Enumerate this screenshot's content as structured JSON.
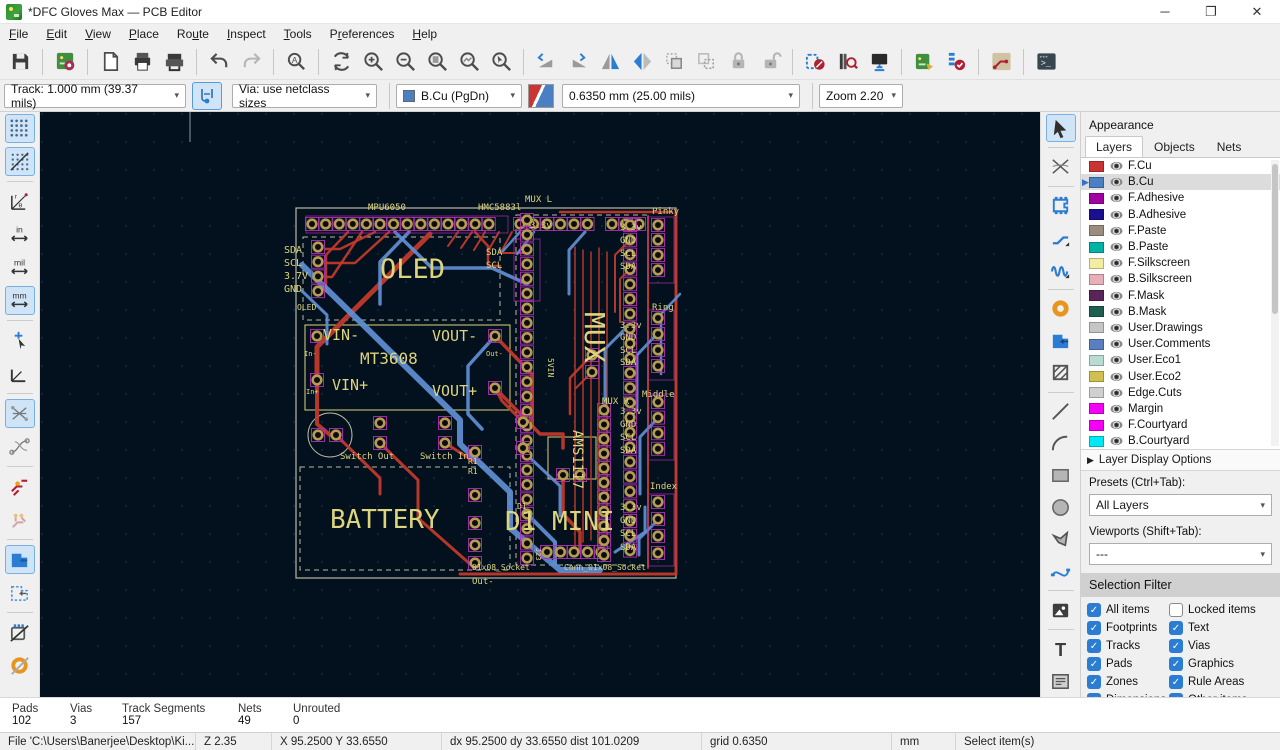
{
  "window": {
    "title": "*DFC Gloves Max — PCB Editor"
  },
  "menu": {
    "items": [
      "&File",
      "&Edit",
      "&View",
      "&Place",
      "Ro&ute",
      "&Inspect",
      "&Tools",
      "P&references",
      "&Help"
    ]
  },
  "toolbar_main": [
    "save",
    "|",
    "board-setup",
    "|",
    "page-settings",
    "print",
    "plot",
    "|",
    "undo",
    "redo:disabled",
    "|",
    "find",
    "|",
    "refresh",
    "zoom-in",
    "zoom-out",
    "zoom-fit",
    "zoom-objects",
    "zoom-selection",
    "|",
    "rotate-ccw",
    "rotate-cw",
    "flip-horizontal",
    "mirror",
    "group",
    "ungroup",
    "lock",
    "unlock",
    "|",
    "footprint-editor",
    "footprint-browser",
    "3d-viewer",
    "|",
    "update-pcb",
    "drc",
    "|",
    "route-style",
    "|",
    "scripting-console"
  ],
  "toolbar2": {
    "track": "Track: 1.000 mm (39.37 mils)",
    "via": "Via: use netclass sizes",
    "layer": "B.Cu (PgDn)",
    "layer_color": "#4a7fc1",
    "grid": "0.6350 mm (25.00 mils)",
    "zoom": "Zoom 2.20"
  },
  "left_toolbar": [
    "grid:active",
    "grid-overrides:active",
    "polar-coords",
    "units-inches",
    "units-mils",
    "units-mm:active",
    "cursor-shape",
    "free-angle",
    "ratsnest:active",
    "curved-ratsnest",
    "net-highlight",
    "track-display",
    "zone-fill:active",
    "zone-outline",
    "footprint-hide",
    "pad-hide"
  ],
  "right_toolbar": [
    "select:active",
    "local-ratsnest",
    "place-footprint",
    "route-tracks",
    "tune-length",
    "place-via",
    "draw-zone",
    "rule-area",
    "draw-line",
    "draw-arc",
    "draw-rect",
    "draw-circle",
    "draw-polygon",
    "draw-bezier",
    "place-image",
    "place-text",
    "place-textbox"
  ],
  "appearance": {
    "title": "Appearance",
    "tabs": [
      "Layers",
      "Objects",
      "Nets"
    ],
    "active_tab": "Layers",
    "layers": [
      {
        "name": "F.Cu",
        "color": "#c83434",
        "selected": false
      },
      {
        "name": "B.Cu",
        "color": "#4a7fc1",
        "selected": true
      },
      {
        "name": "F.Adhesive",
        "color": "#a000a0",
        "selected": false
      },
      {
        "name": "B.Adhesive",
        "color": "#1a0f8f",
        "selected": false
      },
      {
        "name": "F.Paste",
        "color": "#9a8d80",
        "selected": false
      },
      {
        "name": "B.Paste",
        "color": "#00b1a5",
        "selected": false
      },
      {
        "name": "F.Silkscreen",
        "color": "#f2eda0",
        "selected": false
      },
      {
        "name": "B.Silkscreen",
        "color": "#e8aeba",
        "selected": false
      },
      {
        "name": "F.Mask",
        "color": "#592458",
        "selected": false
      },
      {
        "name": "B.Mask",
        "color": "#1e5f52",
        "selected": false
      },
      {
        "name": "User.Drawings",
        "color": "#c5c5c5",
        "selected": false
      },
      {
        "name": "User.Comments",
        "color": "#5a7fc0",
        "selected": false
      },
      {
        "name": "User.Eco1",
        "color": "#b8dcd2",
        "selected": false
      },
      {
        "name": "User.Eco2",
        "color": "#cfc04f",
        "selected": false
      },
      {
        "name": "Edge.Cuts",
        "color": "#d0d0d0",
        "selected": false
      },
      {
        "name": "Margin",
        "color": "#f400f4",
        "selected": false
      },
      {
        "name": "F.Courtyard",
        "color": "#f400f4",
        "selected": false
      },
      {
        "name": "B.Courtyard",
        "color": "#00e8f4",
        "selected": false
      }
    ],
    "layer_display_options": "Layer Display Options",
    "presets_label": "Presets (Ctrl+Tab):",
    "presets_value": "All Layers",
    "viewports_label": "Viewports (Shift+Tab):",
    "viewports_value": "---",
    "selection_filter": {
      "title": "Selection Filter",
      "items": [
        {
          "label": "All items",
          "checked": true
        },
        {
          "label": "Locked items",
          "checked": false
        },
        {
          "label": "Footprints",
          "checked": true
        },
        {
          "label": "Text",
          "checked": true
        },
        {
          "label": "Tracks",
          "checked": true
        },
        {
          "label": "Vias",
          "checked": true
        },
        {
          "label": "Pads",
          "checked": true
        },
        {
          "label": "Graphics",
          "checked": true
        },
        {
          "label": "Zones",
          "checked": true
        },
        {
          "label": "Rule Areas",
          "checked": true
        },
        {
          "label": "Dimensions",
          "checked": true
        },
        {
          "label": "Other items",
          "checked": true
        }
      ]
    }
  },
  "status": {
    "cols": [
      {
        "label": "Pads",
        "value": "102",
        "w": 58
      },
      {
        "label": "Vias",
        "value": "3",
        "w": 52
      },
      {
        "label": "Track Segments",
        "value": "157",
        "w": 116
      },
      {
        "label": "Nets",
        "value": "49",
        "w": 55
      },
      {
        "label": "Unrouted",
        "value": "0",
        "w": 120
      }
    ]
  },
  "statusbar": {
    "file": "File 'C:\\Users\\Banerjee\\Desktop\\Ki...",
    "z": "Z 2.35",
    "xy": "X 95.2500  Y 33.6550",
    "dxdy": "dx 95.2500  dy 33.6550  dist 101.0209",
    "grid": "grid 0.6350",
    "units": "mm",
    "action": "Select item(s)"
  },
  "canvas": {
    "bg": "#03101d",
    "grid_dot": "#16324a",
    "silk": "#ddd57e",
    "fcu": "#c0392b",
    "bcu": "#5f8fd4",
    "pad_ring": "#b59b54",
    "pad_outline": "#b030b0",
    "board": {
      "x": 256,
      "y": 96,
      "w": 380,
      "h": 370
    },
    "labels": [
      {
        "t": "MPU6050",
        "x": 328,
        "y": 98,
        "s": 9
      },
      {
        "t": "HMC5883l",
        "x": 438,
        "y": 98,
        "s": 9
      },
      {
        "t": "MUX L",
        "x": 485,
        "y": 90,
        "s": 9
      },
      {
        "t": "Pinky",
        "x": 612,
        "y": 102,
        "s": 9
      },
      {
        "t": "OLED",
        "x": 340,
        "y": 166,
        "s": 27
      },
      {
        "t": "SDA",
        "x": 244,
        "y": 141,
        "s": 10
      },
      {
        "t": "SCL",
        "x": 244,
        "y": 154,
        "s": 10
      },
      {
        "t": "3.7V",
        "x": 244,
        "y": 167,
        "s": 10
      },
      {
        "t": "GND",
        "x": 244,
        "y": 180,
        "s": 10
      },
      {
        "t": "OLED",
        "x": 257,
        "y": 198,
        "s": 8
      },
      {
        "t": "VIN-",
        "x": 283,
        "y": 228,
        "s": 15
      },
      {
        "t": "VOUT-",
        "x": 392,
        "y": 229,
        "s": 15
      },
      {
        "t": "MT3608",
        "x": 320,
        "y": 252,
        "s": 16
      },
      {
        "t": "VIN+",
        "x": 292,
        "y": 278,
        "s": 15
      },
      {
        "t": "VOUT+",
        "x": 392,
        "y": 284,
        "s": 15
      },
      {
        "t": "In-",
        "x": 264,
        "y": 244,
        "s": 7
      },
      {
        "t": "In+",
        "x": 266,
        "y": 282,
        "s": 7
      },
      {
        "t": "Out-",
        "x": 446,
        "y": 244,
        "s": 7
      },
      {
        "t": "MUX",
        "x": 545,
        "y": 200,
        "s": 28,
        "r": 90
      },
      {
        "t": "5VIN",
        "x": 508,
        "y": 246,
        "s": 8,
        "r": 90
      },
      {
        "t": "AMS1117",
        "x": 533,
        "y": 318,
        "s": 14,
        "r": 90
      },
      {
        "t": "BATTERY",
        "x": 290,
        "y": 416,
        "s": 26
      },
      {
        "t": "D1 MINI",
        "x": 465,
        "y": 418,
        "s": 26
      },
      {
        "t": "Switch Out",
        "x": 300,
        "y": 347,
        "s": 9
      },
      {
        "t": "Switch In",
        "x": 380,
        "y": 347,
        "s": 9
      },
      {
        "t": "R1",
        "x": 428,
        "y": 352,
        "s": 8
      },
      {
        "t": "R1",
        "x": 428,
        "y": 362,
        "s": 8
      },
      {
        "t": "D1",
        "x": 477,
        "y": 397,
        "s": 8
      },
      {
        "t": "MUX R",
        "x": 562,
        "y": 292,
        "s": 9
      },
      {
        "t": "Ring",
        "x": 612,
        "y": 198,
        "s": 9
      },
      {
        "t": "Middle",
        "x": 602,
        "y": 285,
        "s": 9
      },
      {
        "t": "Index",
        "x": 610,
        "y": 377,
        "s": 9
      },
      {
        "t": "3.3v",
        "x": 490,
        "y": 116,
        "s": 9
      },
      {
        "t": "SDA",
        "x": 446,
        "y": 143,
        "s": 9
      },
      {
        "t": "SCL",
        "x": 446,
        "y": 156,
        "s": 9
      },
      {
        "t": "3.3v",
        "x": 580,
        "y": 118,
        "s": 9
      },
      {
        "t": "GND",
        "x": 580,
        "y": 131,
        "s": 9
      },
      {
        "t": "SCL",
        "x": 580,
        "y": 144,
        "s": 9
      },
      {
        "t": "SDA",
        "x": 580,
        "y": 157,
        "s": 9
      },
      {
        "t": "3.3v",
        "x": 580,
        "y": 216,
        "s": 9
      },
      {
        "t": "GND",
        "x": 580,
        "y": 228,
        "s": 9
      },
      {
        "t": "SCL",
        "x": 580,
        "y": 241,
        "s": 9
      },
      {
        "t": "SDA",
        "x": 580,
        "y": 253,
        "s": 9
      },
      {
        "t": "3.3v",
        "x": 580,
        "y": 302,
        "s": 9
      },
      {
        "t": "GND",
        "x": 580,
        "y": 315,
        "s": 9
      },
      {
        "t": "SCL",
        "x": 580,
        "y": 328,
        "s": 9
      },
      {
        "t": "SDA",
        "x": 580,
        "y": 341,
        "s": 9
      },
      {
        "t": "3.3v",
        "x": 580,
        "y": 398,
        "s": 9
      },
      {
        "t": "GND",
        "x": 580,
        "y": 411,
        "s": 9
      },
      {
        "t": "SCL",
        "x": 580,
        "y": 424,
        "s": 9
      },
      {
        "t": "SDA",
        "x": 580,
        "y": 438,
        "s": 9
      },
      {
        "t": "01x08_Socket",
        "x": 432,
        "y": 458,
        "s": 8
      },
      {
        "t": "Conn_01x08_Socket",
        "x": 524,
        "y": 458,
        "s": 8
      },
      {
        "t": "Out-",
        "x": 432,
        "y": 472,
        "s": 9
      },
      {
        "t": "J23",
        "x": 496,
        "y": 436,
        "s": 7,
        "r": 90
      }
    ],
    "headers": [
      {
        "x": 272,
        "y": 112,
        "n": 14,
        "dx": 13.6,
        "dy": 0
      },
      {
        "x": 480,
        "y": 112,
        "n": 6,
        "dx": 13.5,
        "dy": 0
      },
      {
        "x": 572,
        "y": 112,
        "n": 3,
        "dx": 13.5,
        "dy": 0
      },
      {
        "x": 278,
        "y": 135,
        "n": 4,
        "dx": 0,
        "dy": 14.7
      },
      {
        "x": 487,
        "y": 108,
        "n": 24,
        "dx": 0,
        "dy": 14.7
      },
      {
        "x": 590,
        "y": 113,
        "n": 23,
        "dx": 0,
        "dy": 14.8
      },
      {
        "x": 618,
        "y": 113,
        "n": 4,
        "dx": 0,
        "dy": 15
      },
      {
        "x": 618,
        "y": 206,
        "n": 4,
        "dx": 0,
        "dy": 16
      },
      {
        "x": 618,
        "y": 290,
        "n": 4,
        "dx": 0,
        "dy": 15.6
      },
      {
        "x": 618,
        "y": 390,
        "n": 4,
        "dx": 0,
        "dy": 17
      },
      {
        "x": 507,
        "y": 440,
        "n": 5,
        "dx": 13.5,
        "dy": 0
      },
      {
        "x": 564,
        "y": 298,
        "n": 11,
        "dx": 0,
        "dy": 14.5
      }
    ],
    "pads": [
      [
        277,
        224
      ],
      [
        277,
        268
      ],
      [
        455,
        224
      ],
      [
        455,
        276
      ],
      [
        340,
        311
      ],
      [
        340,
        331
      ],
      [
        405,
        311
      ],
      [
        405,
        331
      ],
      [
        278,
        323
      ],
      [
        296,
        323
      ],
      [
        435,
        340
      ],
      [
        435,
        383
      ],
      [
        435,
        411
      ],
      [
        435,
        433
      ],
      [
        435,
        451
      ],
      [
        483,
        310
      ],
      [
        483,
        336
      ],
      [
        523,
        363
      ],
      [
        540,
        363
      ],
      [
        552,
        243
      ],
      [
        552,
        260
      ]
    ],
    "dashed_rects": [
      {
        "x": 263,
        "y": 125,
        "w": 197,
        "h": 83
      },
      {
        "x": 260,
        "y": 355,
        "w": 210,
        "h": 103
      },
      {
        "x": 476,
        "y": 103,
        "w": 132,
        "h": 350
      }
    ],
    "solid_rects": [
      {
        "x": 265,
        "y": 213,
        "w": 205,
        "h": 85
      },
      {
        "x": 508,
        "y": 325,
        "w": 48,
        "h": 42
      }
    ],
    "group_rects": [
      {
        "x": 608,
        "y": 105,
        "w": 26,
        "h": 66
      },
      {
        "x": 608,
        "y": 198,
        "w": 26,
        "h": 70
      },
      {
        "x": 608,
        "y": 282,
        "w": 26,
        "h": 66
      },
      {
        "x": 608,
        "y": 382,
        "w": 26,
        "h": 72
      },
      {
        "x": 266,
        "y": 104,
        "w": 202,
        "h": 17
      },
      {
        "x": 474,
        "y": 127,
        "w": 26,
        "h": 62
      }
    ],
    "traces_red": [
      {
        "w": 5,
        "p": "390,122 277,235 277,268"
      },
      {
        "w": 4,
        "p": "277,268 277,312 290,323"
      },
      {
        "w": 2.5,
        "p": "335,120 300,137 286,137"
      },
      {
        "w": 2.5,
        "p": "349,120 315,151 286,151"
      },
      {
        "w": 2.5,
        "p": "322,120 292,165 286,165"
      },
      {
        "w": 2.5,
        "p": "308,120 286,143 286,179"
      },
      {
        "w": 2,
        "p": "418,120 408,134"
      },
      {
        "w": 2,
        "p": "432,120 421,136"
      },
      {
        "w": 2,
        "p": "445,120 434,138"
      },
      {
        "w": 2,
        "p": "459,120 448,139"
      },
      {
        "w": 2,
        "p": "472,120 461,140"
      },
      {
        "w": 2.5,
        "p": "435,120 448,134 448,154 460,154"
      },
      {
        "w": 2,
        "p": "460,141 487,141"
      },
      {
        "w": 3.5,
        "p": "455,224 492,262 492,310"
      },
      {
        "w": 3.5,
        "p": "455,276 500,322 523,322 523,336"
      },
      {
        "w": 3,
        "p": "483,310 462,289 455,276"
      },
      {
        "w": 3.5,
        "p": "523,363 523,402 540,420 540,440"
      },
      {
        "w": 3,
        "p": "340,331 378,368 378,406 430,452"
      },
      {
        "w": 3,
        "p": "405,331 435,350"
      },
      {
        "w": 3,
        "p": "296,323 340,366 340,382"
      },
      {
        "w": 2.5,
        "p": "552,243 530,266 530,302"
      },
      {
        "w": 2,
        "p": "552,260 536,276"
      },
      {
        "w": 1.5,
        "p": "535,135 535,435"
      },
      {
        "w": 1.5,
        "p": "543,138 543,430"
      },
      {
        "w": 1.5,
        "p": "551,140 551,428"
      },
      {
        "w": 1.5,
        "p": "559,136 559,432"
      },
      {
        "w": 1.5,
        "p": "567,140 567,425"
      },
      {
        "w": 2,
        "p": "608,104 608,456"
      },
      {
        "w": 3,
        "p": "636,100 636,462"
      },
      {
        "w": 3,
        "p": "420,462 636,462"
      },
      {
        "w": 2.5,
        "p": "520,100 632,100"
      },
      {
        "w": 2,
        "p": "590,128 575,143 575,200"
      },
      {
        "w": 2,
        "p": "590,157 580,167 580,210"
      }
    ],
    "traces_blue": [
      {
        "w": 6,
        "p": "262,153 305,195 420,308 420,332 470,380 470,416 520,458 560,458"
      },
      {
        "w": 3.5,
        "p": "355,120 392,156 452,156 487,172"
      },
      {
        "w": 3.5,
        "p": "369,120 340,150 340,192"
      },
      {
        "w": 2.5,
        "p": "480,120 463,139"
      },
      {
        "w": 2.5,
        "p": "494,120 477,142"
      },
      {
        "w": 3.5,
        "p": "455,224 428,254 428,302 442,317"
      },
      {
        "w": 3,
        "p": "487,343 520,374 520,404"
      },
      {
        "w": 3,
        "p": "590,212 565,237 565,302"
      },
      {
        "w": 3,
        "p": "618,221 597,243 597,298"
      },
      {
        "w": 3,
        "p": "618,306 600,325 600,382"
      },
      {
        "w": 3,
        "p": "618,408 599,427 599,443"
      },
      {
        "w": 4,
        "p": "487,402 515,430 515,452"
      },
      {
        "w": 2.5,
        "p": "640,182 621,202 621,262"
      },
      {
        "w": 3,
        "p": "262,179 287,203 287,232"
      },
      {
        "w": 3,
        "p": "545,120 529,138 529,182"
      },
      {
        "w": 3,
        "p": "575,440 605,420 605,395"
      }
    ]
  }
}
